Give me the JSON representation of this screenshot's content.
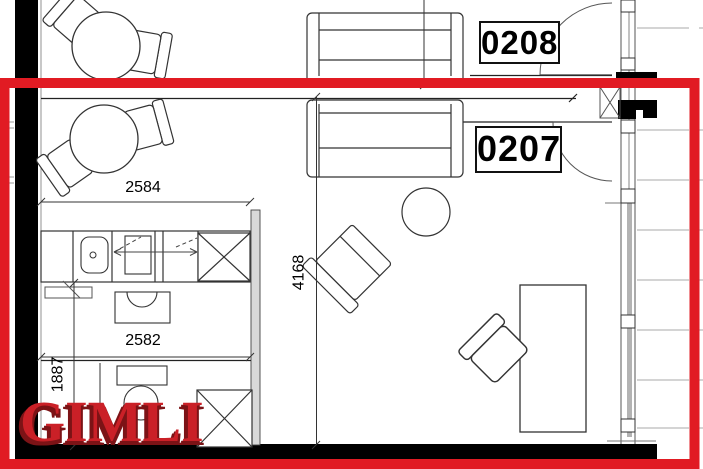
{
  "units": {
    "top": "0208",
    "highlighted": "0207"
  },
  "dimensions": {
    "top_width": "2584",
    "living_depth": "4168",
    "lower_width": "2582",
    "bath_depth": "1887"
  },
  "watermark": {
    "text": "GIMLI"
  },
  "colors": {
    "highlight_border": "#e11b23",
    "watermark_fill": "#ca2027",
    "watermark_shadow": "#7c1316",
    "walls": "#000000",
    "plan_lines": "#2b2b2b",
    "balcony_lines": "#a8a8a8",
    "wall_infill_gray": "#d9d9d9"
  },
  "furniture": {
    "items": [
      "dining-table",
      "dining-chair",
      "sofa",
      "coffee-table",
      "armchair",
      "desk",
      "desk-chair",
      "kitchen-counter",
      "kitchen-sink",
      "cooktop",
      "fridge-cabinet",
      "washbasin",
      "toilet",
      "shower-cabinet",
      "entry-door",
      "bathroom-door",
      "window-wall",
      "balcony-deck"
    ]
  }
}
